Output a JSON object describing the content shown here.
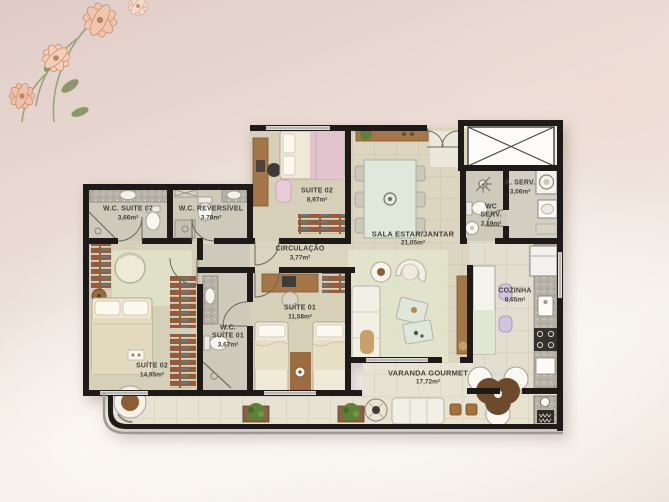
{
  "rooms": {
    "wc_suite02": {
      "label": "W.C. SUITE 02",
      "area": "3,66m²"
    },
    "wc_reversivel": {
      "label": "W.C. REVERSÍVEL",
      "area": "3,78m²"
    },
    "suite02": {
      "label": "SUITE 02",
      "area": "8,97m²"
    },
    "circulacao": {
      "label": "CIRCULAÇÃO",
      "area": "3,77m²"
    },
    "sala": {
      "label": "SALA ESTAR/JANTAR",
      "area": "21,05m²"
    },
    "area_servico": {
      "label": "Á. SERV.",
      "area": "3,06m²"
    },
    "wc_servico": {
      "label": "WC SERV.",
      "area": "2,19m²"
    },
    "cozinha": {
      "label": "COZINHA",
      "area": "8,65m²"
    },
    "suite01": {
      "label": "SUÍTE 01",
      "area": "11,58m²"
    },
    "wc_suite01": {
      "label": "W.C. SUÍTE 01",
      "area": "3,67m²"
    },
    "suite02_master": {
      "label": "SUÍTE 02",
      "area": "14,95m²"
    },
    "varanda": {
      "label": "VARANDA GOURMET",
      "area": "17,72m²"
    }
  },
  "colors": {
    "wall": "#1d1a17",
    "floor_room": "#d7d0b8",
    "floor_wet": "#cdc9bb",
    "floor_kitchen": "#e2ded0",
    "floor_balcony": "#e7e3d2",
    "floor_hall": "#efede6",
    "wood": "#a57748",
    "rug_green": "#dfe2c8",
    "background_pink": "#e8d9d2"
  },
  "decor": {
    "corner_flowers": "flower-illustration"
  }
}
